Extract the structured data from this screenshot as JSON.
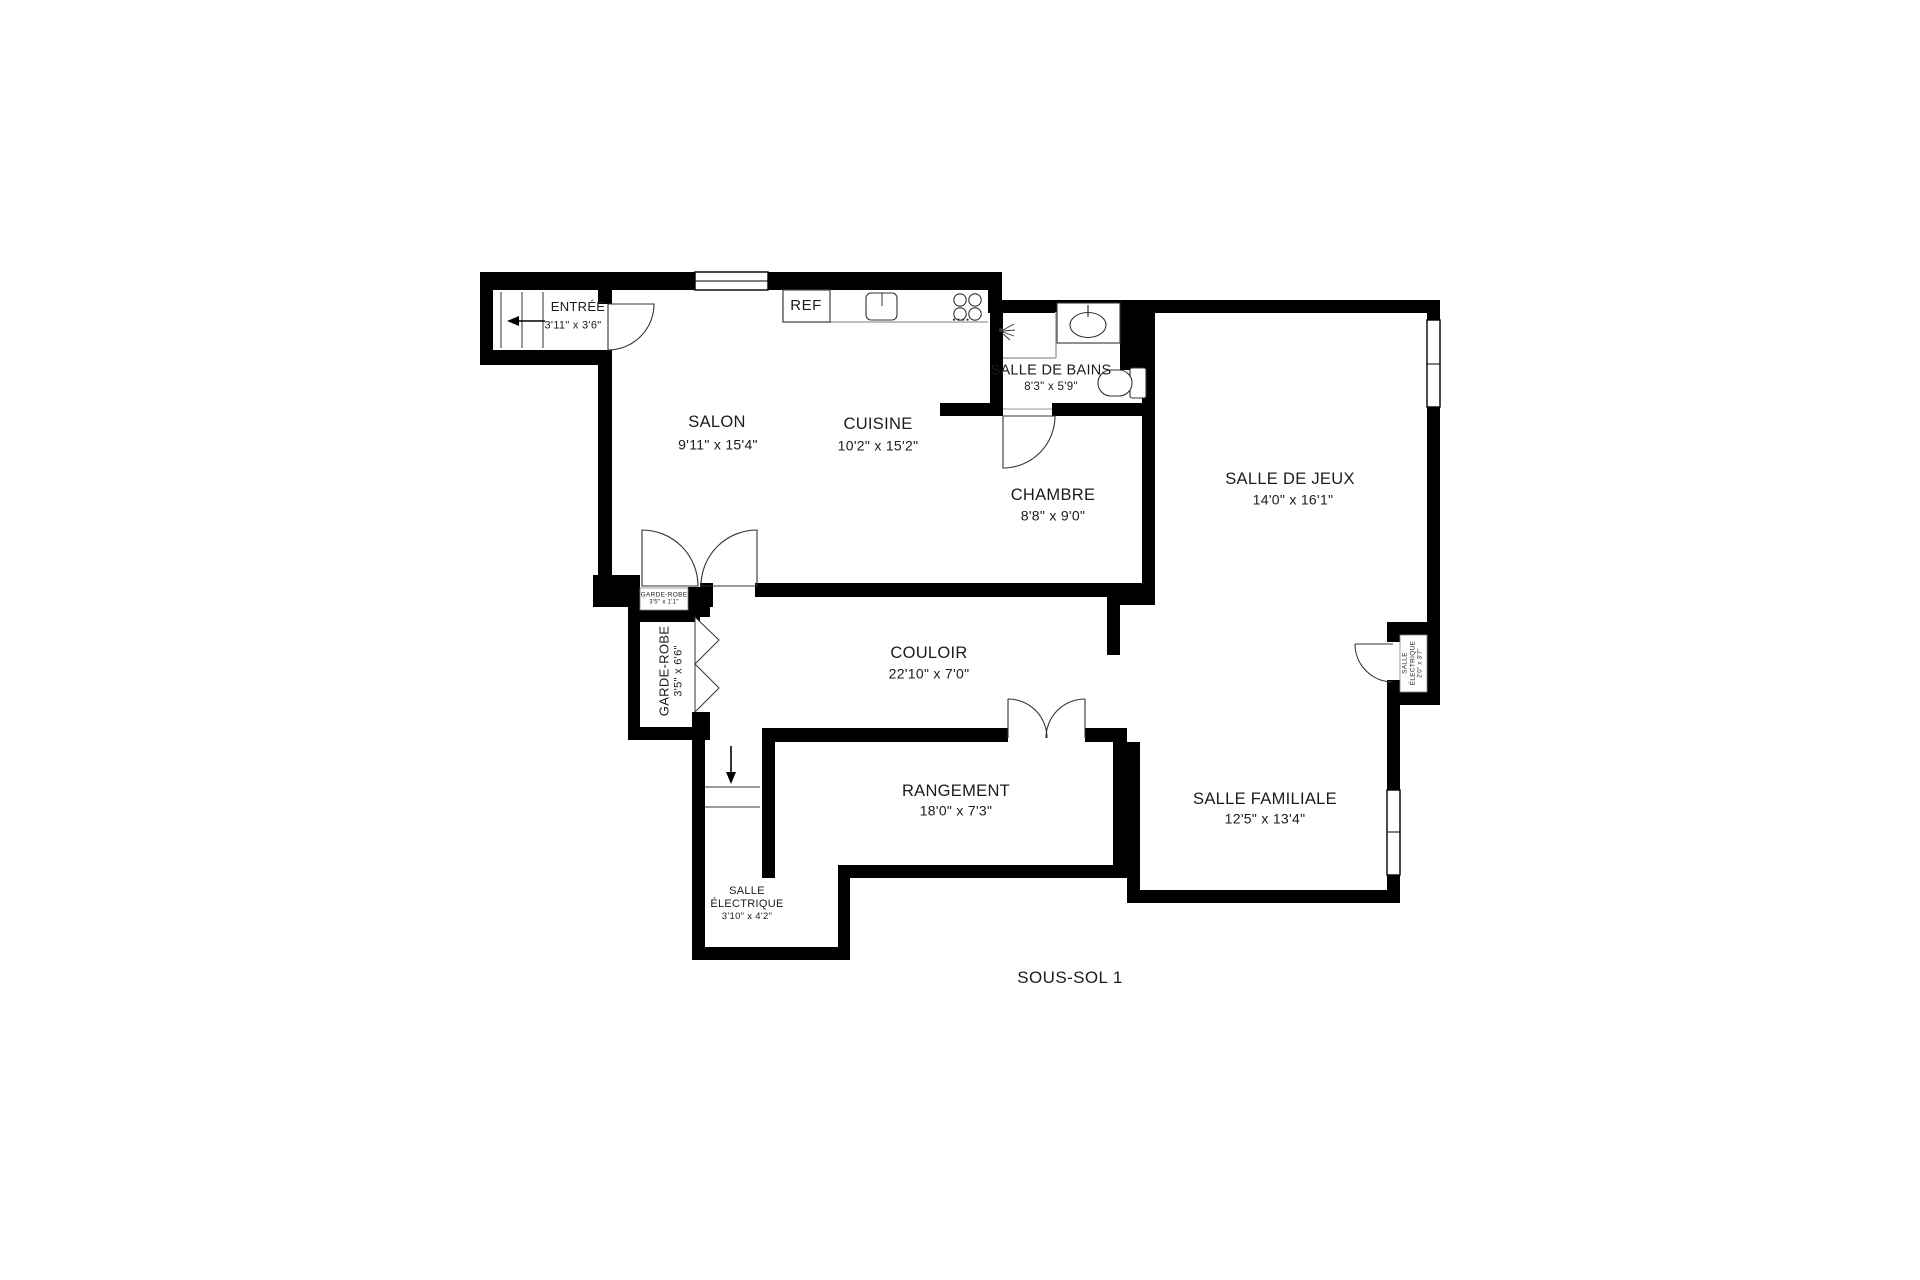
{
  "title": "SOUS-SOL 1",
  "rooms": {
    "entree": {
      "name": "ENTRÉE",
      "dims": "3'11\" x 3'6\""
    },
    "salon": {
      "name": "SALON",
      "dims": "9'11\" x 15'4\""
    },
    "cuisine": {
      "name": "CUISINE",
      "dims": "10'2\" x 15'2\""
    },
    "salle_de_bains": {
      "name": "SALLE DE BAINS",
      "dims": "8'3\" x 5'9\""
    },
    "chambre": {
      "name": "CHAMBRE",
      "dims": "8'8\" x 9'0\""
    },
    "salle_de_jeux": {
      "name": "SALLE DE JEUX",
      "dims": "14'0\" x 16'1\""
    },
    "couloir": {
      "name": "COULOIR",
      "dims": "22'10\" x 7'0\""
    },
    "garde_robe": {
      "name": "GARDE-ROBE",
      "dims": "3'5\" x 6'6\""
    },
    "garde_robe_petit": {
      "name": "GARDE-ROBE",
      "dims": "3'5\" x 1'1\""
    },
    "rangement": {
      "name": "RANGEMENT",
      "dims": "18'0\" x 7'3\""
    },
    "salle_familiale": {
      "name": "SALLE FAMILIALE",
      "dims": "12'5\" x 13'4\""
    },
    "salle_electrique": {
      "line1": "SALLE",
      "line2": "ÉLECTRIQUE",
      "dims": "3'10\" x 4'2\""
    },
    "salle_electrique_droite": {
      "line1": "SALLE",
      "line2": "ÉLECTRIQUE",
      "dims": "2'0\" x 3'7\""
    }
  },
  "fixtures": {
    "ref_label": "REF"
  },
  "colors": {
    "wall": "#000000",
    "background": "#ffffff",
    "line": "#333333"
  }
}
